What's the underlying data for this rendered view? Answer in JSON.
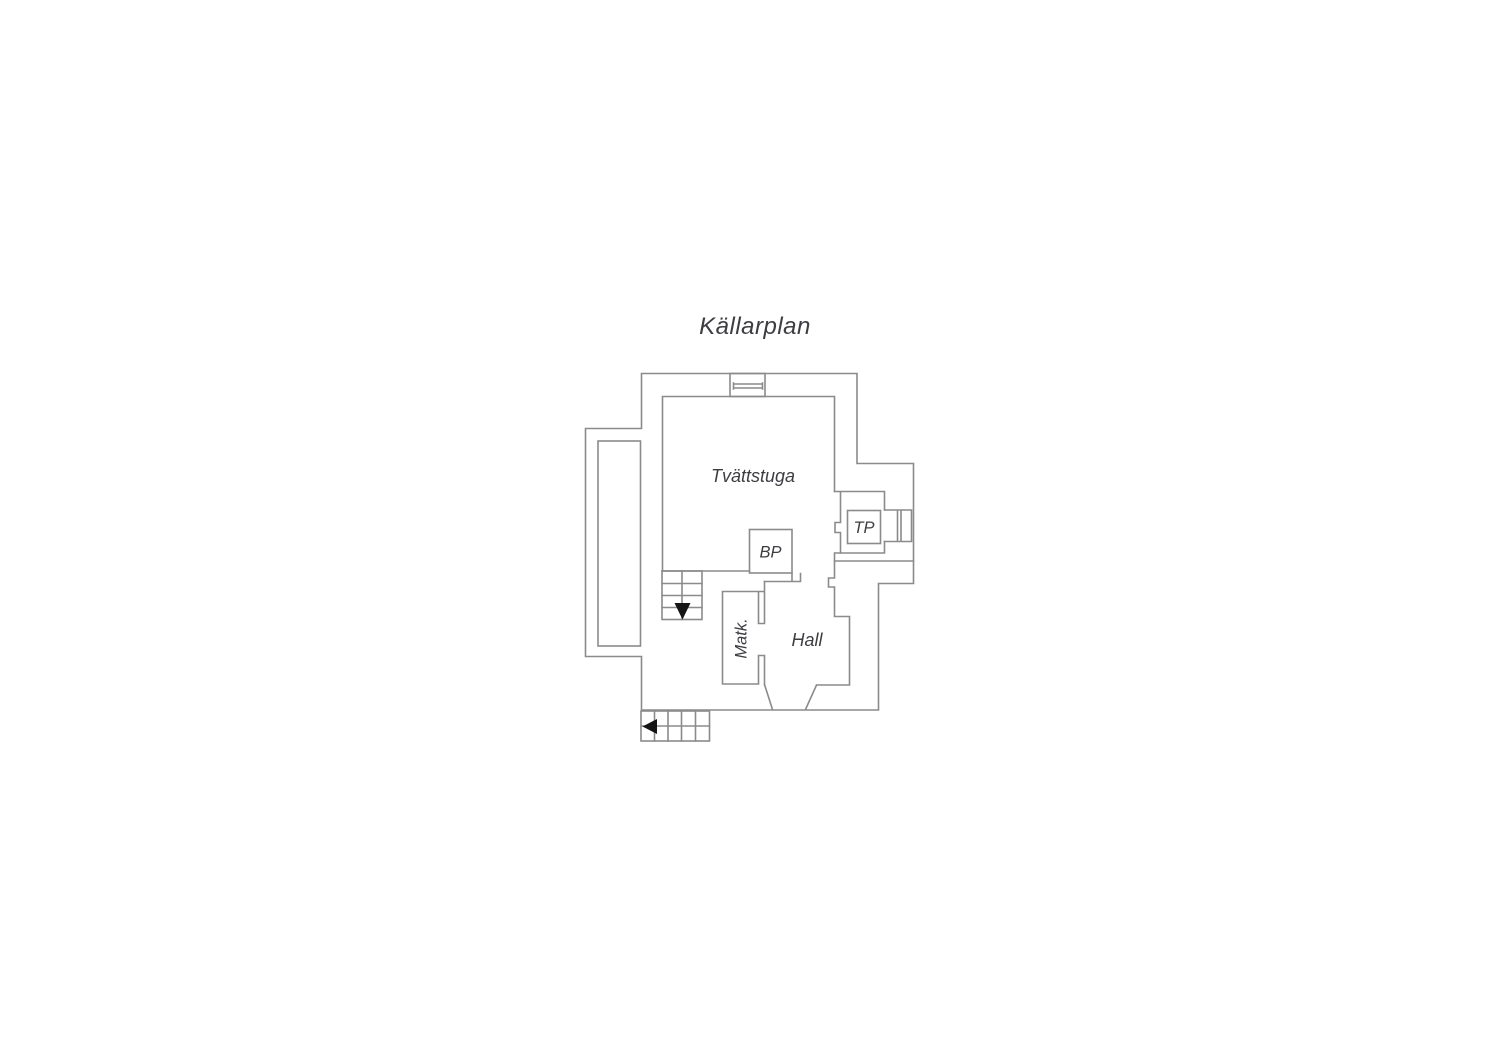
{
  "title": "Källarplan",
  "colors": {
    "background": "#ffffff",
    "wall": "#8b8b8b",
    "text": "#3d3d42",
    "arrow": "#151515"
  },
  "rooms": {
    "laundry": {
      "label": "Tvättstuga"
    },
    "hall": {
      "label": "Hall"
    },
    "pantry": {
      "label": "Matk."
    },
    "bp_unit": {
      "label": "BP"
    },
    "tp_unit": {
      "label": "TP"
    }
  },
  "icons": {
    "stairs_down_arrow": "down-arrow",
    "stairs_exit_arrow": "left-arrow"
  }
}
